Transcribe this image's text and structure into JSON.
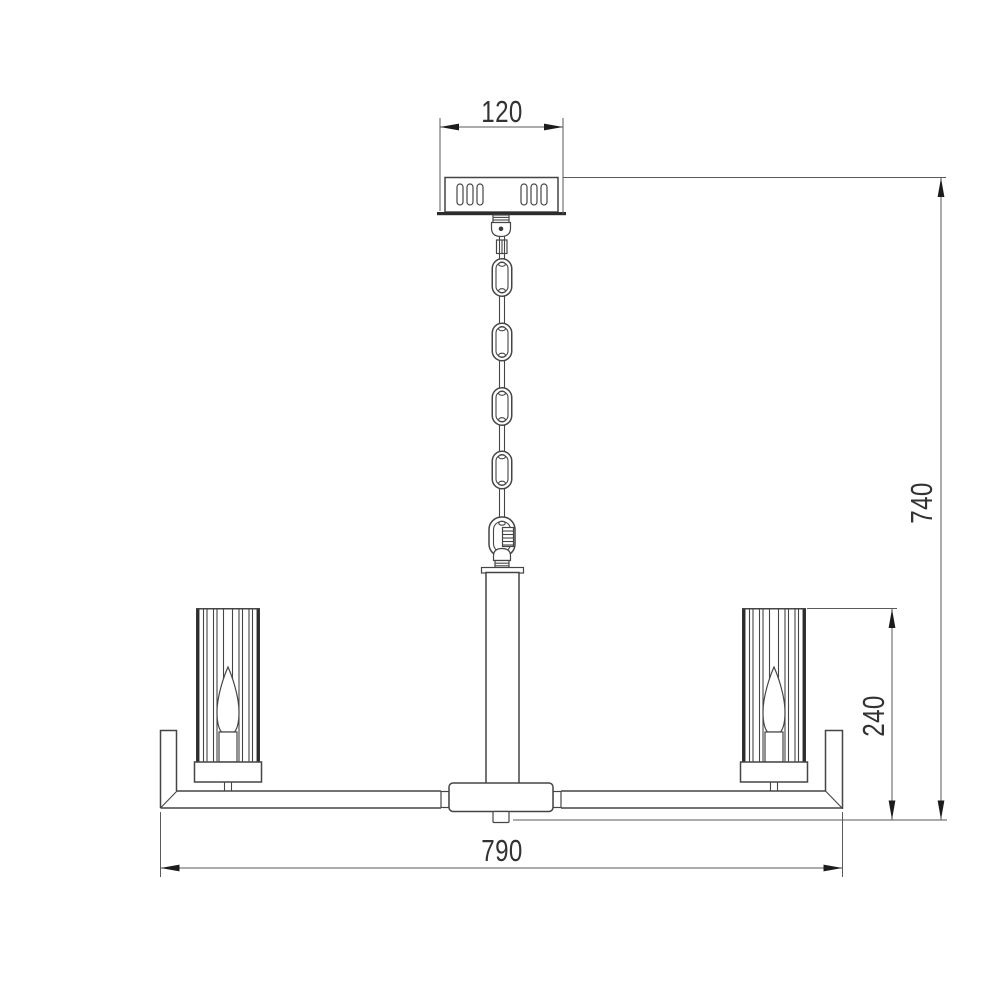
{
  "figure": {
    "description": "chandelier-technical-drawing",
    "dimensions": {
      "canopy_width_label": "120",
      "overall_height_label": "740",
      "shade_drop_label": "240",
      "overall_width_label": "790"
    },
    "style": {
      "line_color": "#454545",
      "dark_color": "#2c2c2c",
      "dim_line_color": "#5a5a5a",
      "arrow_color": "#1c1c1c",
      "text_color": "#333333",
      "background": "#ffffff"
    }
  }
}
